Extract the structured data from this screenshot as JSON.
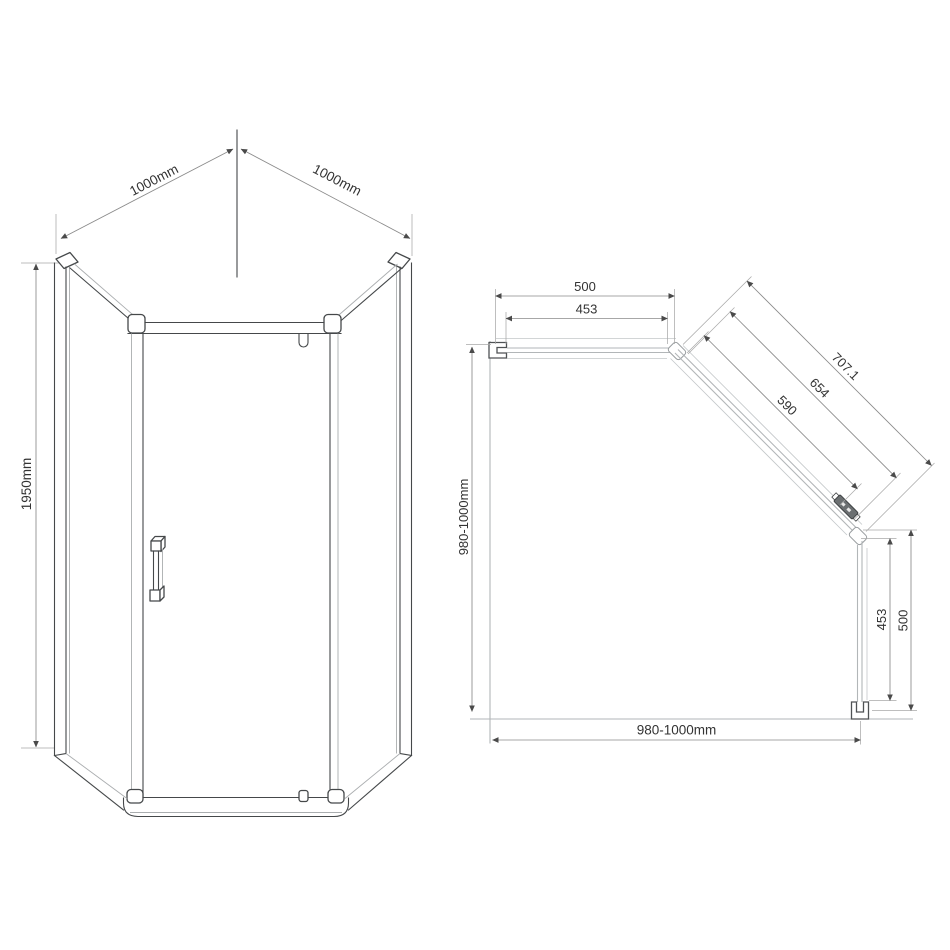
{
  "front": {
    "width_left": "1000mm",
    "width_right": "1000mm",
    "height": "1950mm"
  },
  "plan": {
    "back_overall": "500",
    "back_glass": "453",
    "diag_overall": "707.1",
    "diag_mid": "654",
    "diag_door": "590",
    "depth_range": "980-1000mm",
    "width_range": "980-1000mm",
    "side_glass": "453",
    "side_overall": "500"
  },
  "colors": {
    "background": "#ffffff",
    "outline_dark": "#45484a",
    "outline_light": "#b2b6b8",
    "dimension_line": "#8a8a8a",
    "text": "#333333"
  }
}
